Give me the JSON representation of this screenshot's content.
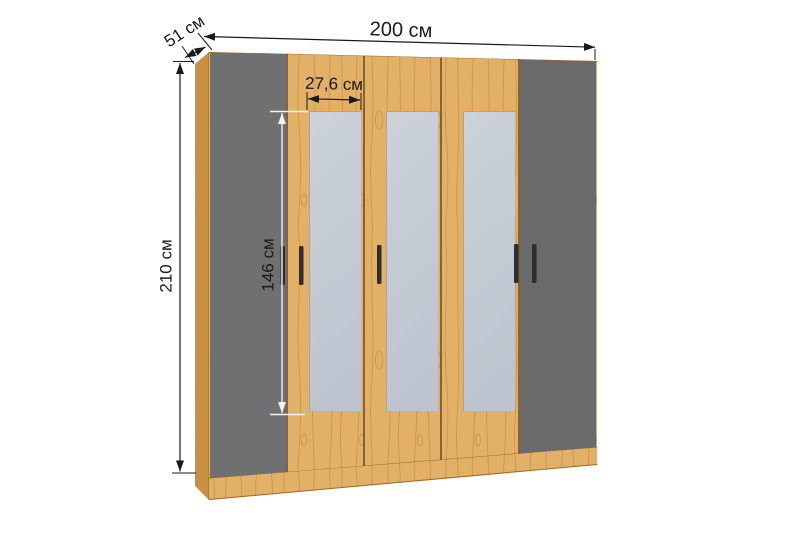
{
  "diagram": {
    "kind": "wardrobe-dimension-diagram",
    "structure": {
      "door_count": 5,
      "mirrored_door_count": 3,
      "handle_count": 5
    }
  },
  "dimensions": {
    "width_label": "200 см",
    "depth_label": "51 см",
    "height_label": "210 см",
    "mirror_width_label": "27,6 см",
    "mirror_height_label": "146 см"
  },
  "colors": {
    "background": "#ffffff",
    "wood": "#e2b167",
    "wood_side": "#c9913f",
    "wood_streak": "#b9823a",
    "wood_edge": "#8a5c20",
    "gap": "#5e3f16",
    "door_gray": "#6f7072",
    "door_gray_right": "#696a6c",
    "mirror_light": "#ccd2db",
    "mirror_dark": "#bec4cf",
    "mirror_edge": "#9aa1ad",
    "handle": "#2e2e30",
    "dimension": "#1a1a1a",
    "dimension_light": "#f2f2f2"
  }
}
